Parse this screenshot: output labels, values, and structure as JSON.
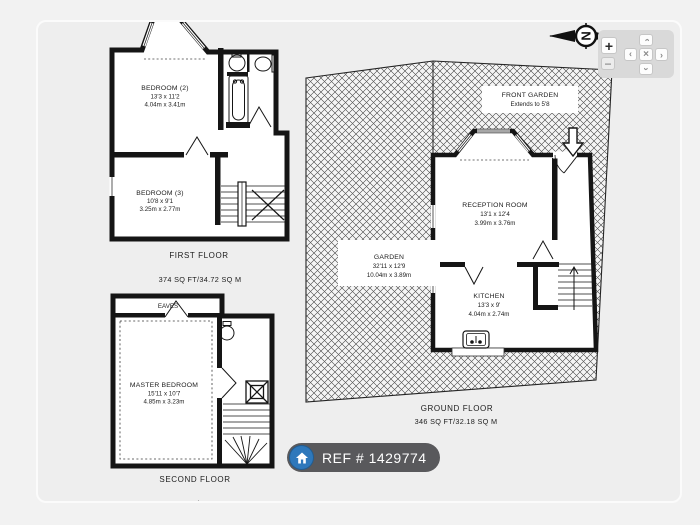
{
  "viewer": {
    "colors": {
      "page_bg": "#f2f2f2",
      "panel_bg": "#eeeeee",
      "badge_bg": "#59595c",
      "badge_icon_blue": "#2e78bb",
      "wall_black": "#151515"
    },
    "compass": {
      "letter": "N"
    },
    "controls": {
      "zoom_in": "+",
      "zoom_out": "−",
      "pan_chevron": "›",
      "pan_center": "×"
    }
  },
  "ref_badge": {
    "label": "REF # 1429774"
  },
  "floorplan": {
    "first_floor": {
      "title": "FIRST FLOOR",
      "area": "374 SQ FT/34.72 SQ M",
      "rooms": {
        "bedroom2": {
          "name": "BEDROOM (2)",
          "imperial": "13'3 x 11'2",
          "metric": "4.04m x 3.41m"
        },
        "bedroom3": {
          "name": "BEDROOM (3)",
          "imperial": "10'8 x 9'1",
          "metric": "3.25m x 2.77m"
        }
      }
    },
    "second_floor": {
      "title": "SECOND FLOOR",
      "area_clipped": "168 SQ FT/15.66 SQ M",
      "eaves_label": "EAVES",
      "rooms": {
        "master": {
          "name": "MASTER BEDROOM",
          "imperial": "15'11 x 10'7",
          "metric": "4.85m x 3.23m"
        }
      }
    },
    "ground_floor": {
      "title": "GROUND FLOOR",
      "area": "346 SQ FT/32.18 SQ M",
      "rooms": {
        "front_garden": {
          "name": "FRONT GARDEN",
          "note": "Extends to 5'8"
        },
        "garden": {
          "name": "GARDEN",
          "imperial": "32'11 x 12'9",
          "metric": "10.04m x 3.89m"
        },
        "reception": {
          "name": "RECEPTION ROOM",
          "imperial": "13'1 x 12'4",
          "metric": "3.99m x 3.76m"
        },
        "kitchen": {
          "name": "KITCHEN",
          "imperial": "13'3 x 9'",
          "metric": "4.04m x 2.74m"
        }
      }
    }
  }
}
